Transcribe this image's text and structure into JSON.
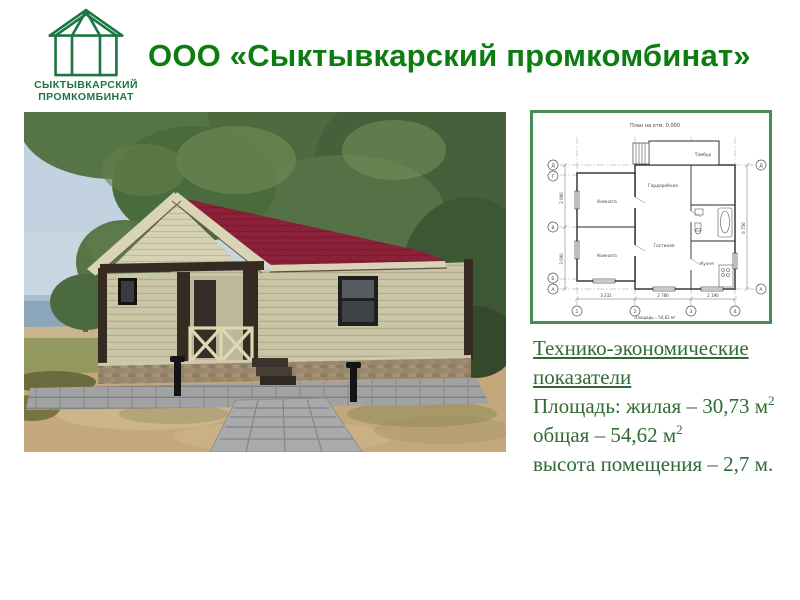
{
  "logo": {
    "line1": "СЫКТЫВКАРСКИЙ",
    "line2": "ПРОМКОМБИНАТ"
  },
  "title": "ООО «Сыктывкарский промкомбинат»",
  "indicators": {
    "heading_line1": "Технико-экономические",
    "heading_line2": "показатели",
    "living_area": "Площадь: жилая – 30,73 м",
    "total_area": "общая – 54,62 м",
    "sup": "2",
    "height_line": "высота помещения –  2,7 м."
  },
  "floor_plan": {
    "title": "План на отм. 0.000",
    "room_labels": [
      "Комната",
      "Комната",
      "Гардеробная",
      "Гостиная",
      "Тамбур",
      "Кухня"
    ],
    "axis_letters_left": [
      "Д",
      "Г",
      "В",
      "Б",
      "А"
    ],
    "axis_letters_right": [
      "Д",
      "А"
    ],
    "axis_numbers": [
      "1",
      "2",
      "3",
      "4"
    ],
    "dims_bottom": [
      "3 232",
      "2 780",
      "2 190"
    ],
    "dims_left": [
      "2 980",
      "3 090"
    ],
    "dims_right": [
      "6 756"
    ],
    "caption": "Площадь – 54,62 м²"
  },
  "photo": {
    "description": "3D render of a single-storey timber-frame house with dark red shingle roof, beige siding, stone base and grey paver walkway among pine trees by a lake"
  },
  "colors": {
    "title_green": "#0d7d11",
    "logo_green": "#1d7544",
    "text_green": "#2f6b33",
    "plan_border_green": "#4a8b54",
    "roof_maroon": "#8c2239",
    "siding_beige": "#cbc5a8",
    "timber_dark": "#352b22"
  }
}
